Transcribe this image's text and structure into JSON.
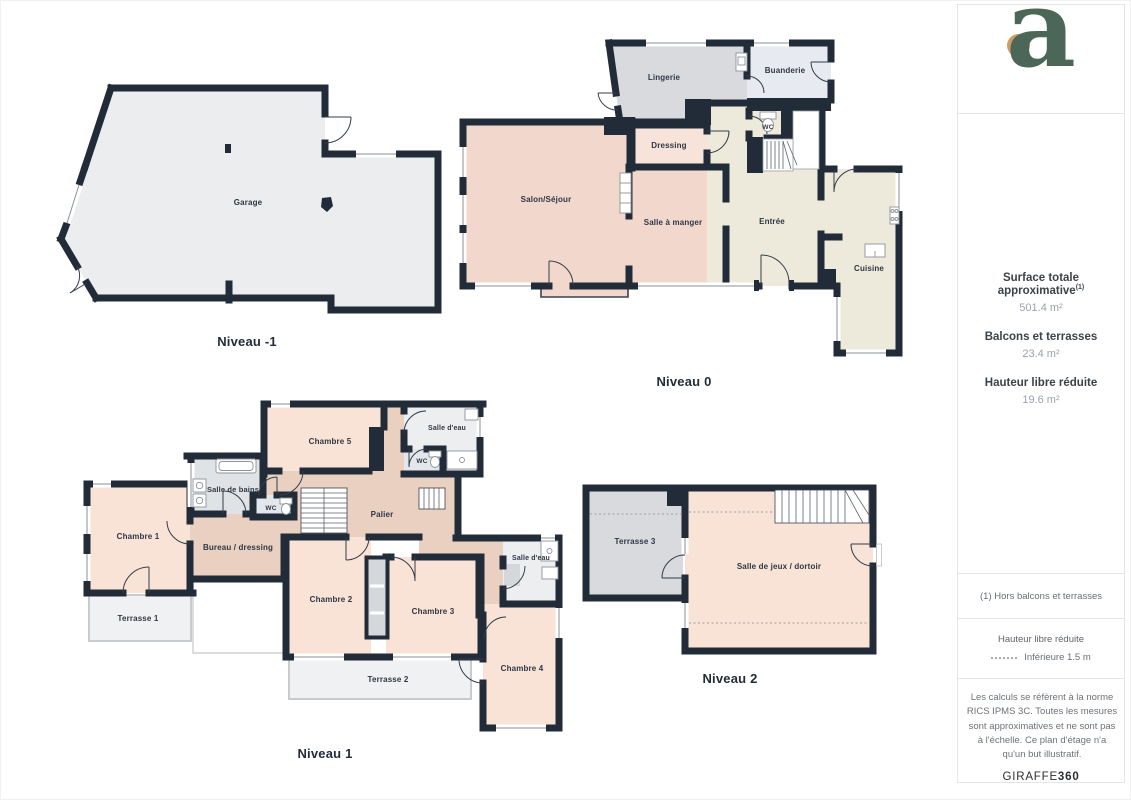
{
  "floors": {
    "m1": "Niveau -1",
    "n0": "Niveau 0",
    "n1": "Niveau 1",
    "n2": "Niveau 2"
  },
  "rooms": {
    "garage": "Garage",
    "lingerie": "Lingerie",
    "buanderie": "Buanderie",
    "wc": "WC",
    "dressing": "Dressing",
    "salon": "Salon/Séjour",
    "salle_a_manger": "Salle à manger",
    "entree": "Entrée",
    "cuisine": "Cuisine",
    "chambre1": "Chambre 1",
    "chambre2": "Chambre 2",
    "chambre3": "Chambre 3",
    "chambre4": "Chambre 4",
    "chambre5": "Chambre 5",
    "salle_de_bains": "Salle de bains",
    "salle_deau": "Salle d'eau",
    "bureau": "Bureau / dressing",
    "palier": "Palier",
    "terrasse1": "Terrasse 1",
    "terrasse2": "Terrasse 2",
    "terrasse3": "Terrasse 3",
    "salle_de_jeux": "Salle de jeux / dortoir"
  },
  "sidebar": {
    "logo_letter": "a",
    "surface_title": "Surface totale approximative",
    "surface_note_marker": "(1)",
    "surface_value": "501.4 m²",
    "balcons_title": "Balcons et terrasses",
    "balcons_value": "23.4 m²",
    "hauteur_title": "Hauteur libre réduite",
    "hauteur_value": "19.6 m²",
    "footnote": "(1) Hors balcons et terrasses",
    "legend_title": "Hauteur libre réduite",
    "legend_value": "Inférieure 1.5 m",
    "disclaimer": "Les calculs se réfèrent à la norme RICS IPMS 3C. Toutes les mesures sont approximatives et ne sont pas à l'échelle. Ce plan d'étage n'a qu'un but illustratif.",
    "brand_regular": "GIRAFFE",
    "brand_bold": "360"
  },
  "colors": {
    "wall": "#222b38",
    "logo_green": "#4c6757",
    "logo_tan": "#cf9d66",
    "room_pink": "#f9e3d6",
    "room_salmon": "#f1d7cc",
    "room_cream": "#eeeadb",
    "room_tan": "#e9d0c1",
    "room_gray": "#d8dadd",
    "bath_gray": "#e0e3e6",
    "terrace_gray": "#f0f1f3"
  }
}
